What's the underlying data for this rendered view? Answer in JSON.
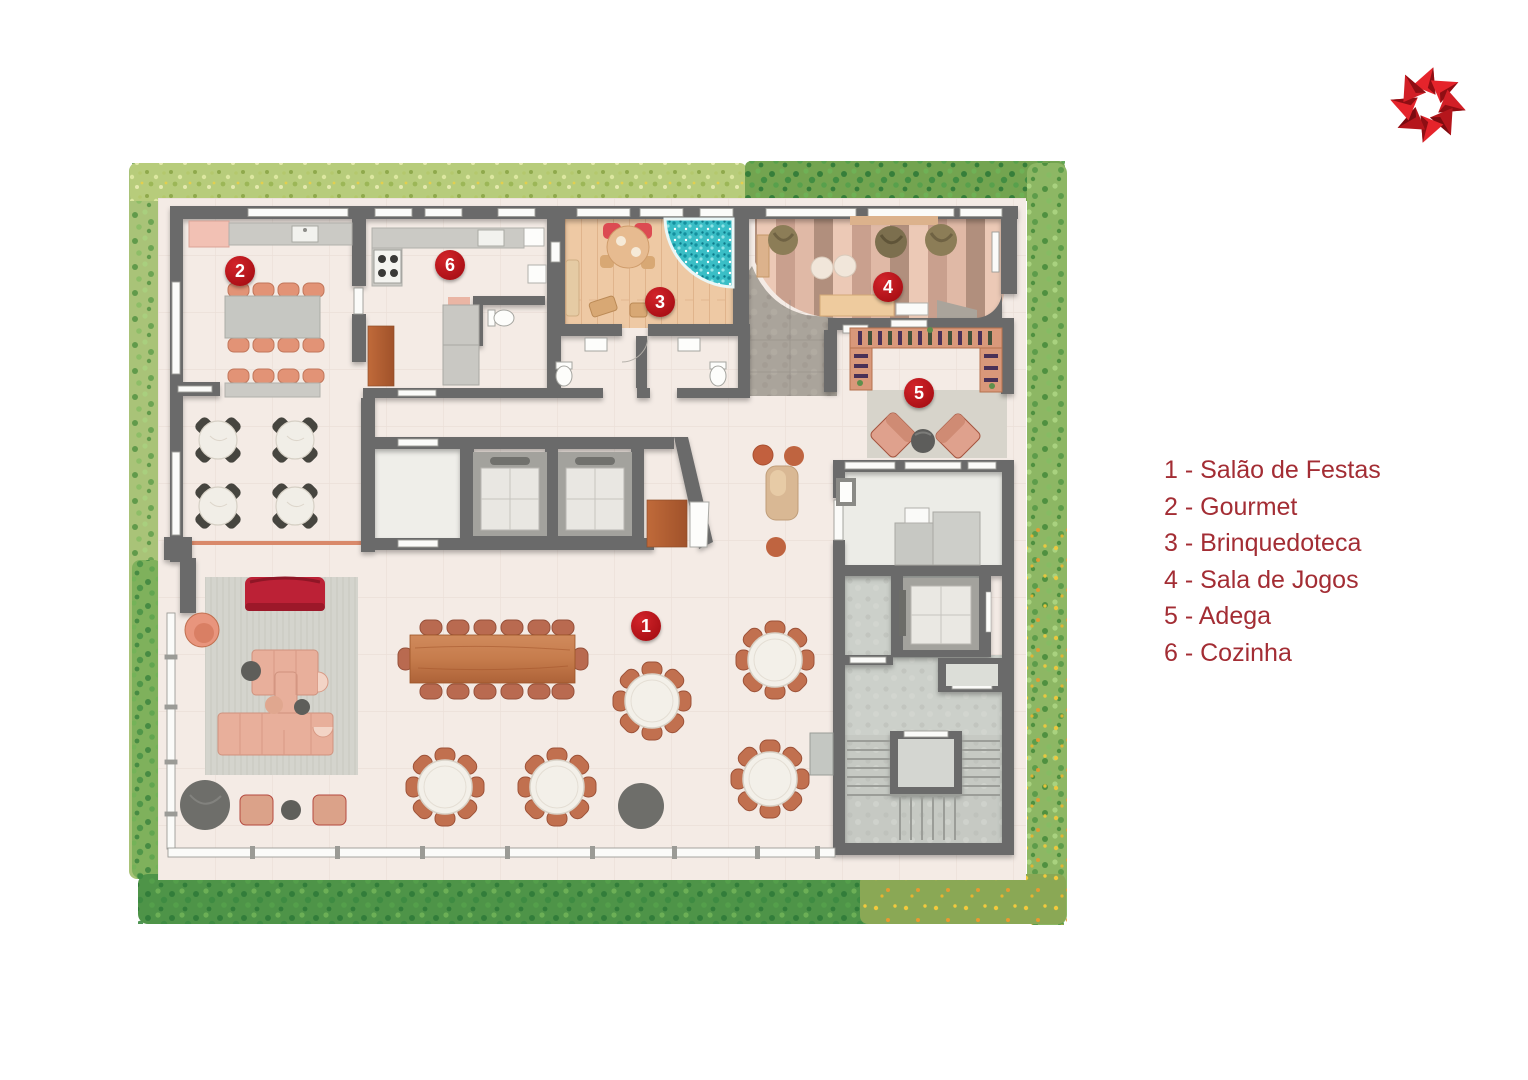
{
  "page": {
    "background_color": "#ffffff"
  },
  "brand": {
    "logo_icon": "eight-point-star-logo",
    "logo_color": "#e5242b",
    "logo_shade_color": "#8f0e13"
  },
  "legend": {
    "text_color": "#a32d34",
    "items": [
      {
        "number": "1",
        "room": "Salão de Festas",
        "label": "1 - Salão de Festas"
      },
      {
        "number": "2",
        "room": "Gourmet",
        "label": "2 - Gourmet"
      },
      {
        "number": "3",
        "room": "Brinquedoteca",
        "label": "3 - Brinquedoteca"
      },
      {
        "number": "4",
        "room": "Sala de Jogos",
        "label": "4 - Sala de Jogos"
      },
      {
        "number": "5",
        "room": "Adega",
        "label": "5 - Adega"
      },
      {
        "number": "6",
        "room": "Cozinha",
        "label": "6 - Cozinha"
      }
    ]
  },
  "floor_plan": {
    "marker_color": "#c0161c",
    "markers": [
      {
        "number": "1",
        "room": "Salão de Festas"
      },
      {
        "number": "2",
        "room": "Gourmet"
      },
      {
        "number": "3",
        "room": "Brinquedoteca"
      },
      {
        "number": "4",
        "room": "Sala de Jogos"
      },
      {
        "number": "5",
        "room": "Adega"
      },
      {
        "number": "6",
        "room": "Cozinha"
      }
    ],
    "visible_features": [
      "garden-hedge-border",
      "glass-facade",
      "gourmet-dining-table",
      "cafe-tables",
      "kitchen-counter-stove",
      "playroom-ball-pit",
      "games-room-bean-bags",
      "bar-counter",
      "wine-rack",
      "lounge-armchairs",
      "party-hall-round-tables",
      "long-banquet-table",
      "lounge-sofas",
      "passenger-elevators",
      "service-elevator",
      "staircase",
      "toilets"
    ]
  }
}
